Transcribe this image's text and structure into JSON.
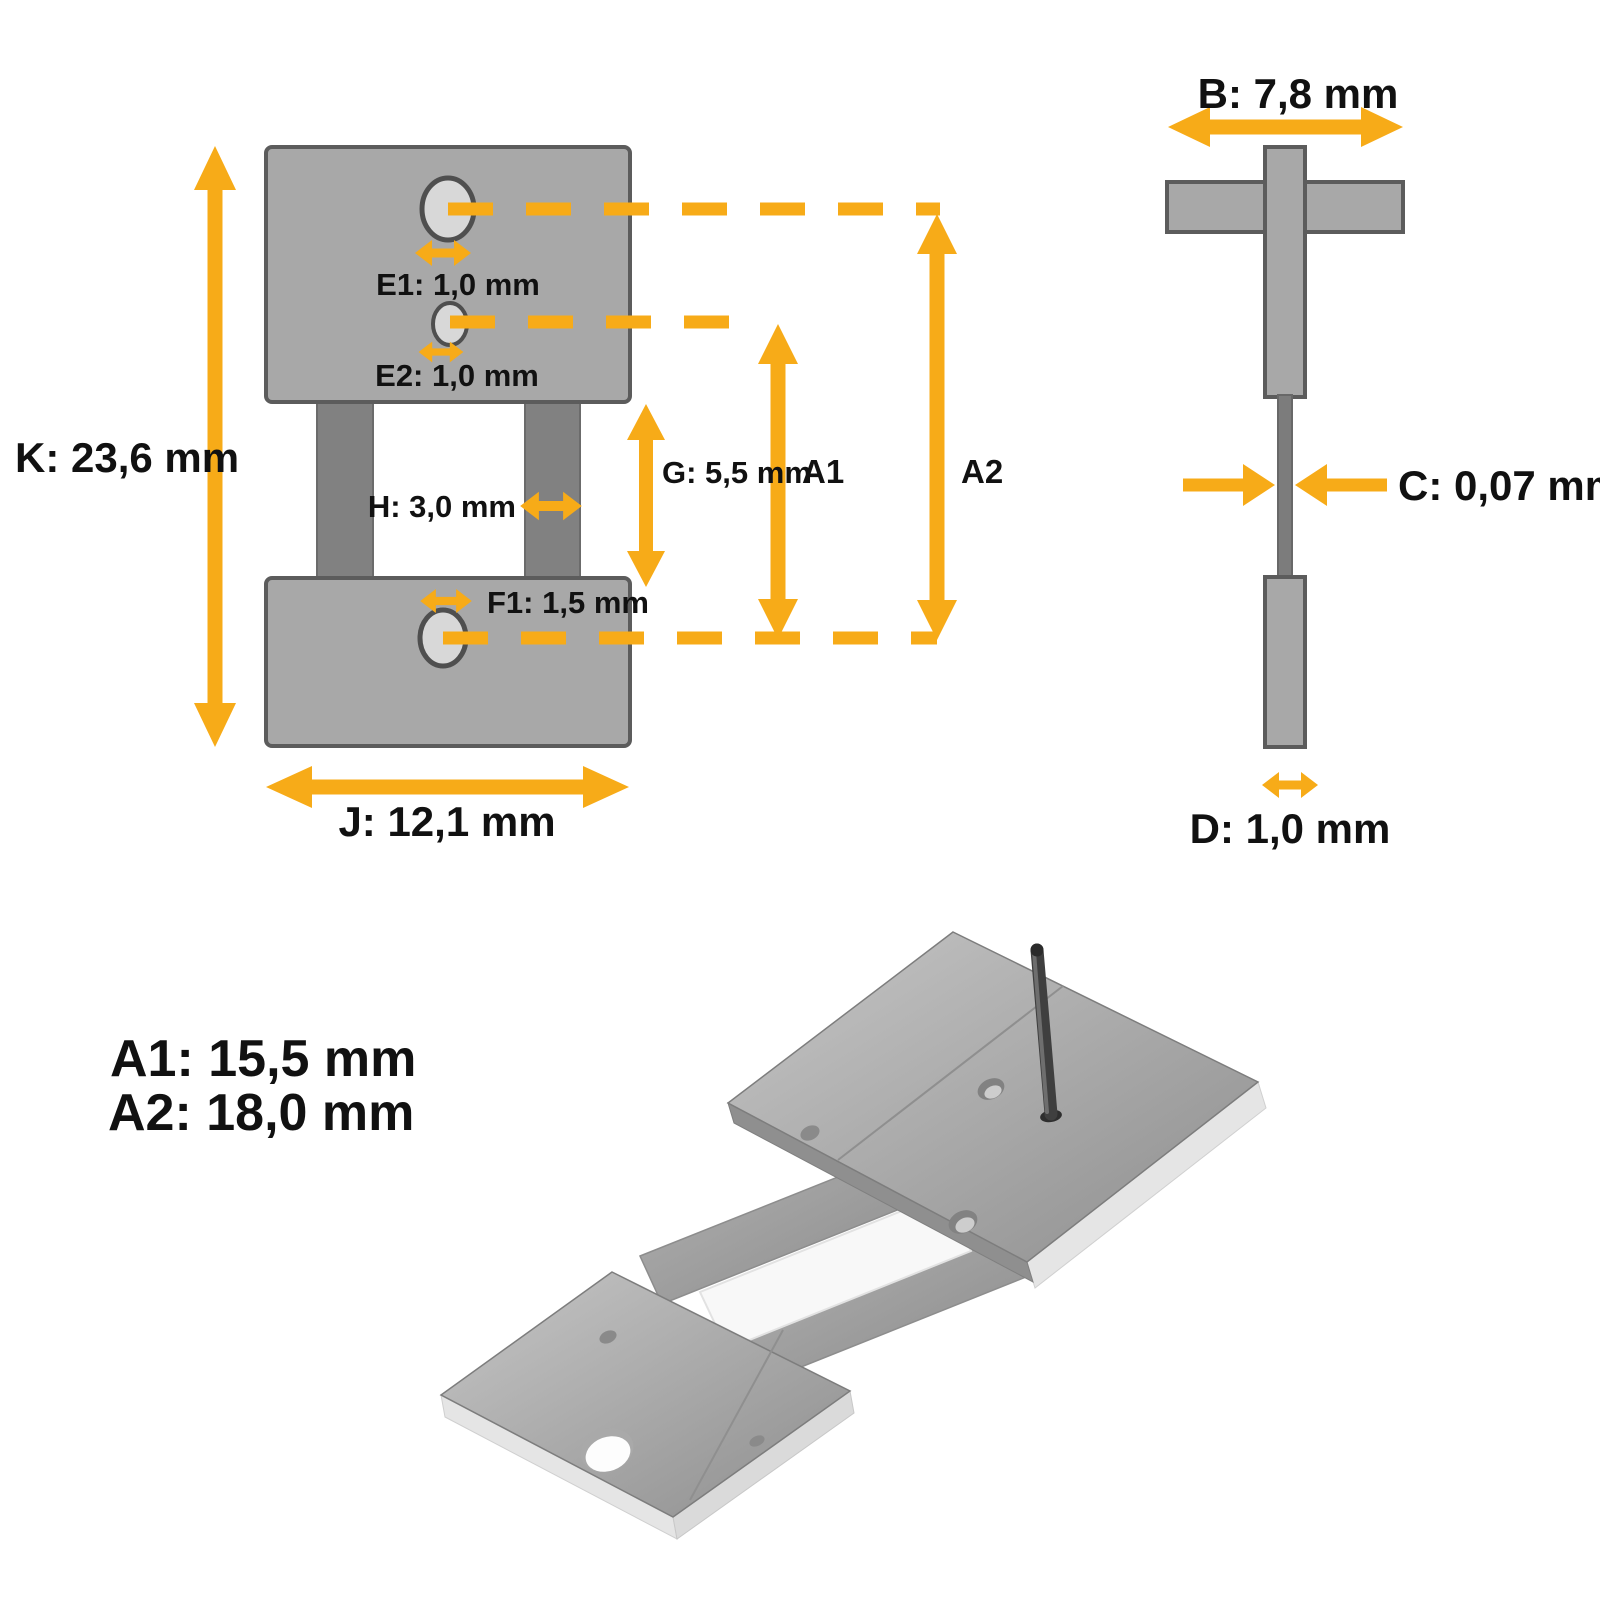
{
  "colors": {
    "accent": "#F7AB18",
    "ink": "#111111",
    "bg": "#FFFFFF",
    "block-fill": "#A8A8A8",
    "block-stroke": "#5C5C5C",
    "leg-fill": "#818181",
    "hole-fill": "#D8D8D8",
    "hole-stroke": "#4F4F4F",
    "spring-fill": "#7C7C7C",
    "metal-light": "#C6C6C6",
    "metal-dark": "#8E8E8E",
    "foam": "#E5E5E5",
    "pin": "#3F3F3F"
  },
  "front_view": {
    "labels": {
      "k": "K: 23,6 mm",
      "j": "J: 12,1 mm",
      "e1": "E1: 1,0 mm",
      "e2": "E2: 1,0 mm",
      "f1": "F1: 1,5 mm",
      "h": "H: 3,0 mm",
      "g": "G: 5,5 mm",
      "a1": "A1",
      "a2": "A2"
    }
  },
  "side_view": {
    "labels": {
      "b": "B: 7,8 mm",
      "c": "C: 0,07 mm",
      "d": "D: 1,0 mm"
    }
  },
  "legend": {
    "a1": "A1: 15,5 mm",
    "a2": "A2: 18,0 mm"
  },
  "photo": {
    "subject": "suspension-spring-part-photo"
  }
}
